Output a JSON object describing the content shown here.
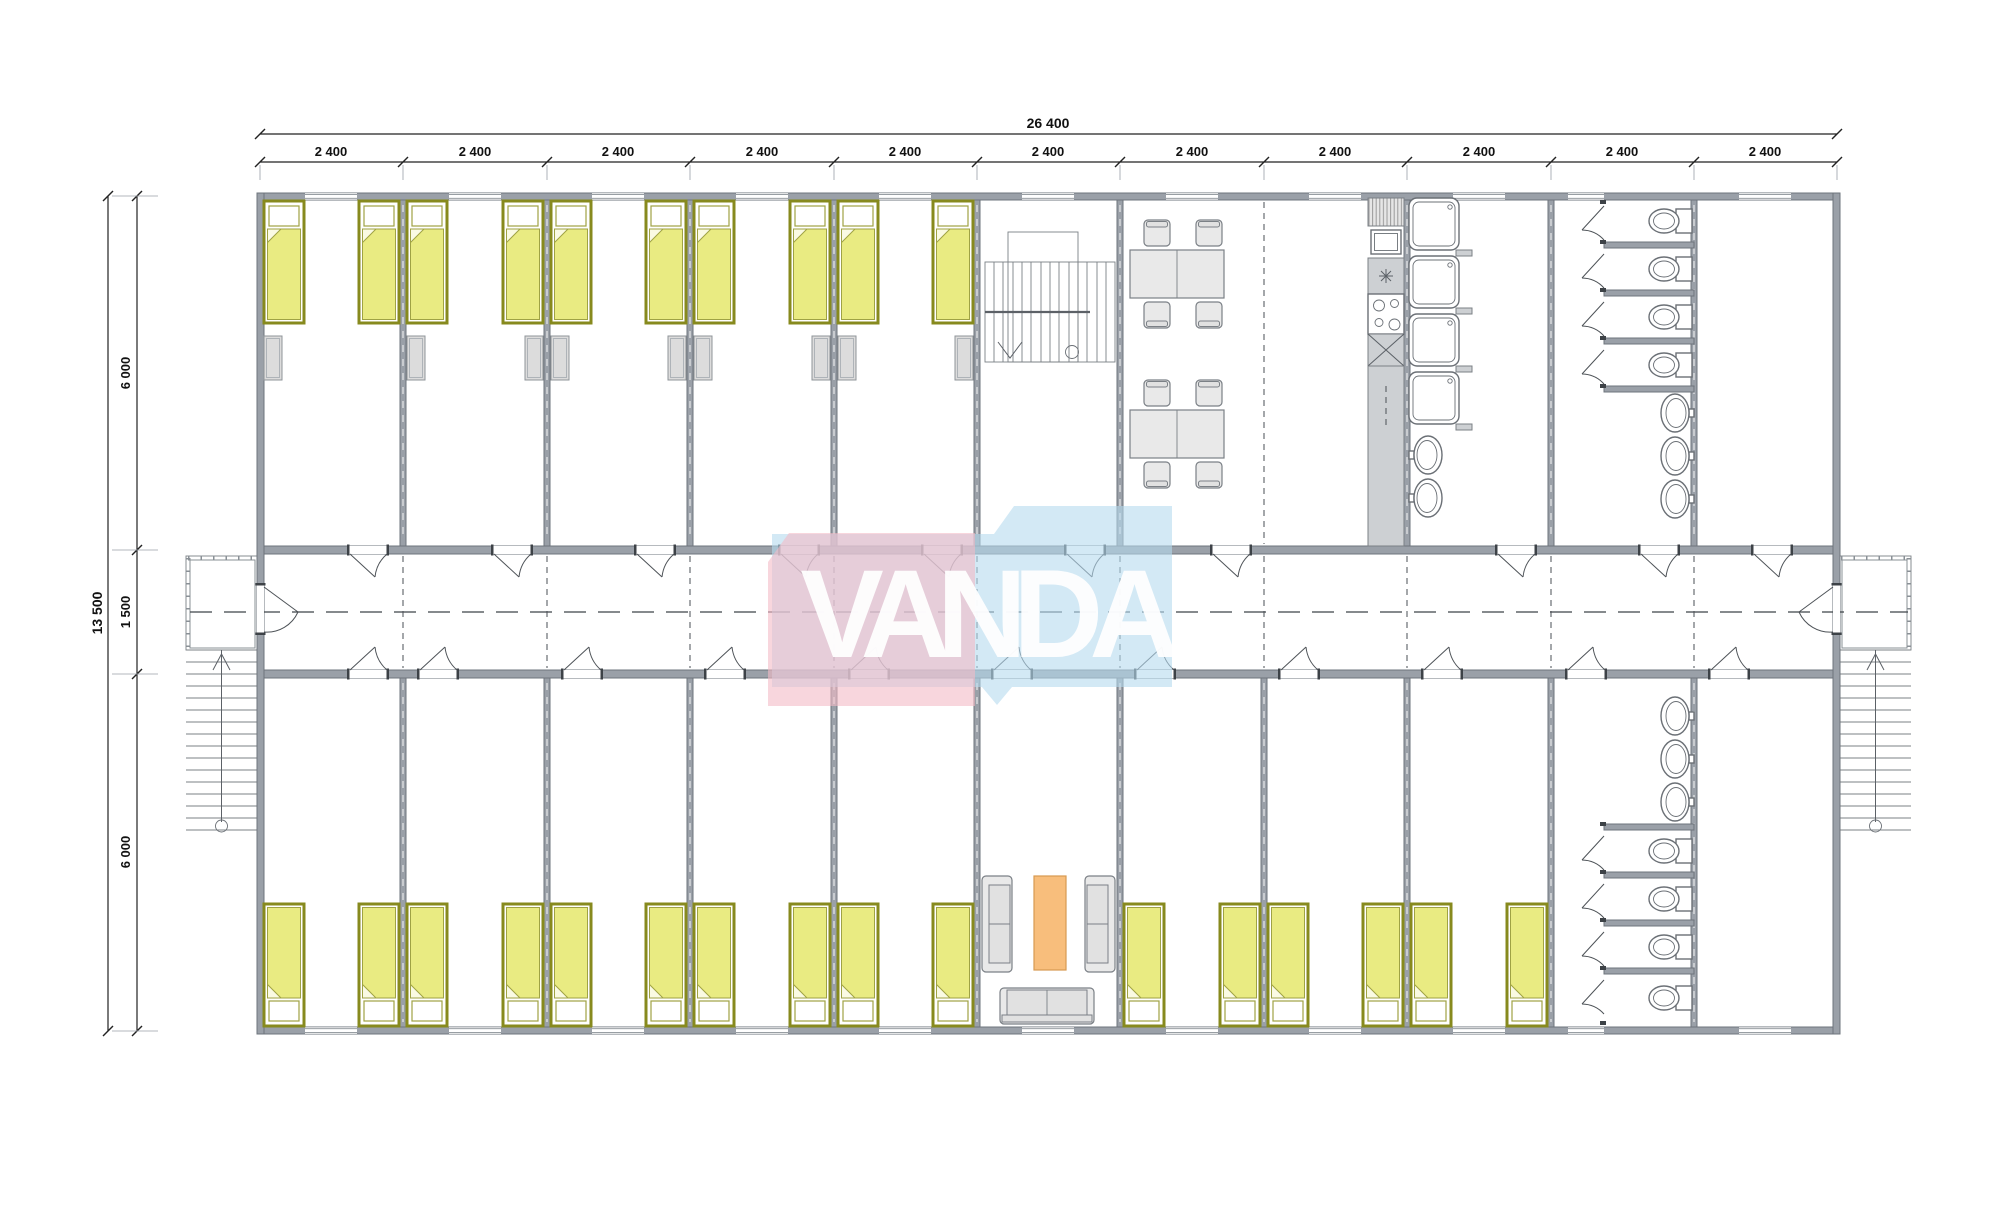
{
  "logo": {
    "text": "VANDA",
    "pink": "#f3bbc7",
    "blue": "#b5daee"
  },
  "dimensions": {
    "total_width": "26 400",
    "module": "2 400",
    "module_count": 11,
    "total_height": "13 500",
    "segment_top": "6 000",
    "segment_mid": "1 500",
    "segment_bottom": "6 000"
  },
  "plan": {
    "colors": {
      "wall": "#9aa0a8",
      "bed": "#e9eb82",
      "bed_frame": "#878a1e",
      "rug": "#f8be7c"
    },
    "rooms_top": [
      "bedroom",
      "bedroom",
      "bedroom",
      "bedroom",
      "bedroom",
      "staircase",
      "dining",
      "dining",
      "showers",
      "toilets",
      "storage"
    ],
    "rooms_bottom": [
      "bedroom",
      "bedroom",
      "bedroom",
      "bedroom",
      "bedroom",
      "lounge",
      "bedroom",
      "bedroom",
      "bedroom",
      "toilets",
      "storage"
    ],
    "fixture_counts": {
      "beds": 26,
      "wardrobes": 9,
      "showers": 4,
      "toilets": 8,
      "wash_basins": 8,
      "dining_tables": 2,
      "sofas": 3
    }
  }
}
